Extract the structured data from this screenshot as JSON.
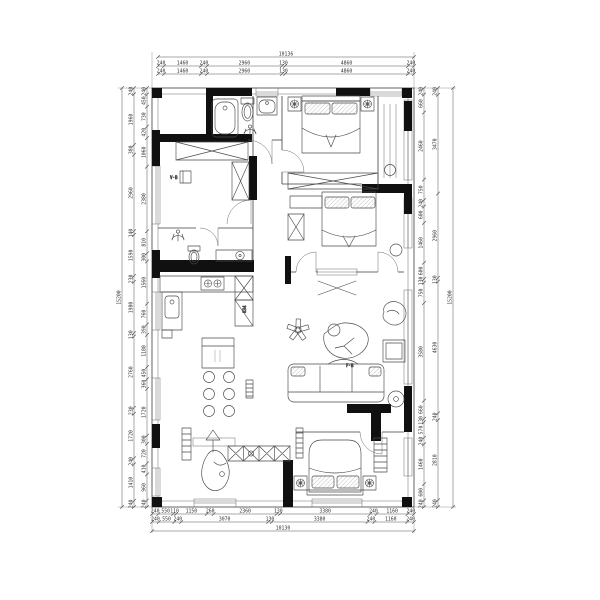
{
  "drawing": {
    "type": "residential floor plan (CAD)",
    "colors": {
      "background": "#ffffff",
      "walls": "#101010",
      "lines": "#3d3d3d",
      "dimensions": "#333333"
    },
    "annotations": {
      "cabinet_depth": "834",
      "living_room": "F·B",
      "bedroom": "V·B"
    },
    "dimensions": {
      "top": {
        "total": [
          "10136"
        ],
        "rows": [
          [
            "240",
            "1460",
            "240",
            "2960",
            "130",
            "4860",
            "240"
          ],
          [
            "240",
            "1460",
            "240",
            "2960",
            "130",
            "4860",
            "240"
          ]
        ]
      },
      "bottom": {
        "total": [
          "10130"
        ],
        "rows": [
          [
            "240",
            "550",
            "110",
            "1150",
            "260",
            "2360",
            "130",
            "3380",
            "240",
            "1160",
            "240"
          ],
          [
            "240",
            "550",
            "240",
            "3070",
            "130",
            "3380",
            "240",
            "1160",
            "240"
          ]
        ]
      },
      "left": {
        "total": [
          "15200"
        ],
        "inner": [
          "240",
          "450",
          "730",
          "420",
          "1060",
          "2380",
          "810",
          "300",
          "1560",
          "760",
          "390",
          "1180",
          "450",
          "360",
          "1720",
          "300",
          "720",
          "410",
          "960",
          "240"
        ],
        "outer": [
          "240",
          "1960",
          "380",
          "2960",
          "140",
          "1590",
          "230",
          "1980",
          "130",
          "2760",
          "230",
          "1720",
          "240",
          "1410",
          "240"
        ]
      },
      "right": {
        "total": [
          "15200"
        ],
        "inner": [
          "240",
          "660",
          "2460",
          "750",
          "240",
          "600",
          "1460",
          "600",
          "130",
          "750",
          "3580",
          "660",
          "130",
          "570",
          "240",
          "1460",
          "600",
          "240"
        ],
        "outer": [
          "240",
          "3470",
          "2960",
          "130",
          "4630",
          "240",
          "2810",
          "240"
        ]
      }
    }
  }
}
